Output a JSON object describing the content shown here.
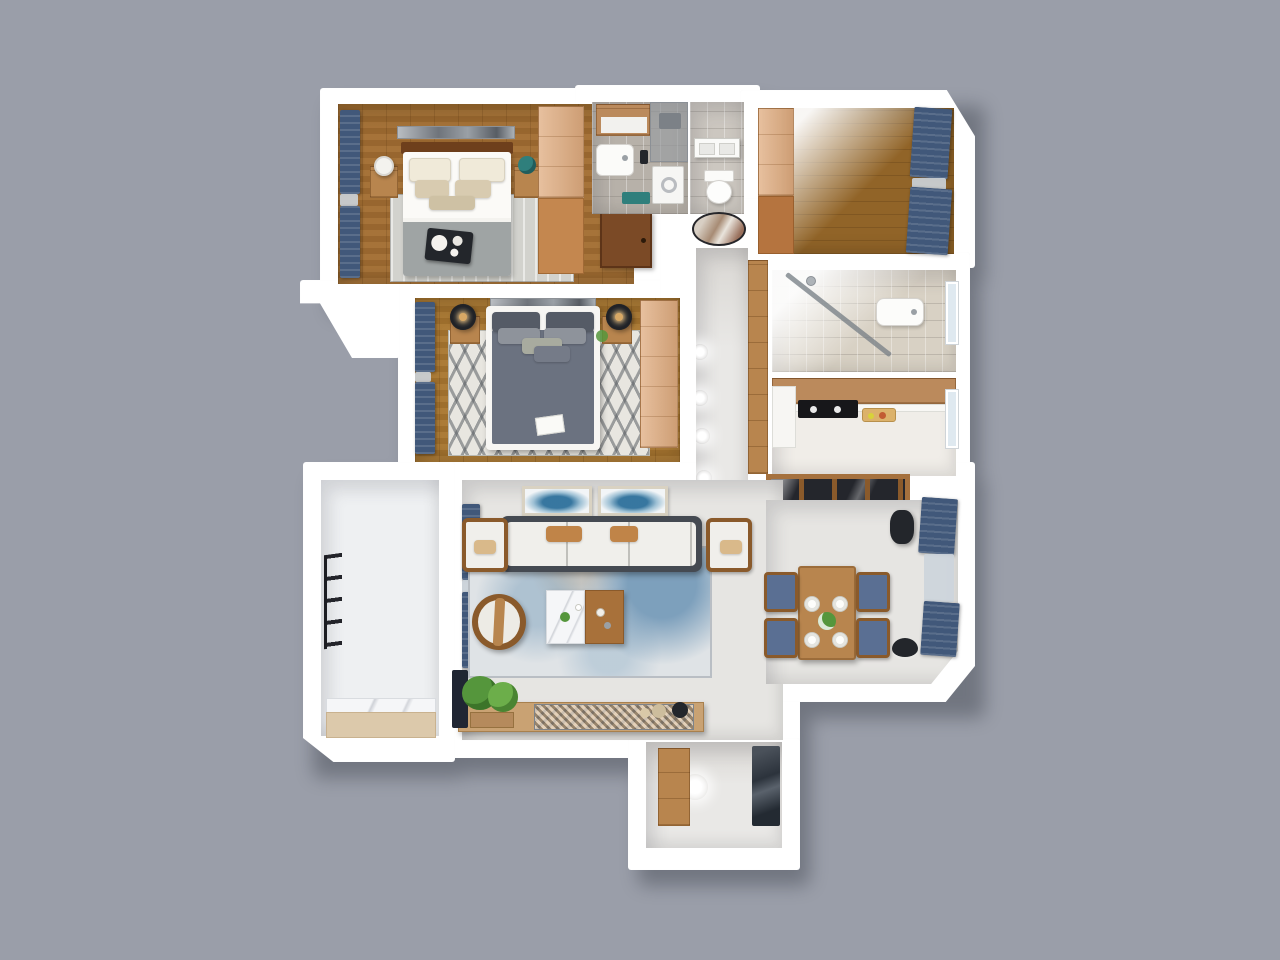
{
  "scene": {
    "title": "3D rendered top-down floor plan of a three-bedroom apartment",
    "view": "axonometric dollhouse render on plain gray backdrop",
    "background": "#9a9ea9"
  },
  "palette": {
    "background": "#9a9ea9",
    "wall": "#ffffff",
    "shadow": "#3f444e",
    "wood_floor_a": "#a06c31",
    "wood_floor_b": "#a7752f",
    "wood_floor_c": "#916428",
    "wood_light": "#dfab7e",
    "wood_mid": "#b8854e",
    "wood_cab": "#bb8a5c",
    "wood_dark": "#7b4a26",
    "headboard": "#6e3f1c",
    "navy": "#41587a",
    "sheer": "#ccd4dc",
    "tile_gray": "#b7b1a9",
    "tile_gray_light": "#ccc7c0",
    "tile_beige": "#d8d1c4",
    "kitchen_floor": "#f0ede8",
    "living_floor": "#e6e5e2",
    "hall_floor": "#e9e8e6",
    "balcony_floor": "#eef0f2",
    "rug_gray": "#d2d2cd",
    "rug_chevron": "#e8e6e0",
    "rug_living": "#dfe3e6",
    "duvet_gray": "#6b7280",
    "blanket_gray": "#9fa4a4",
    "sofa_frame": "#454a52",
    "cushion_white": "#f0efeb",
    "pillow_tan": "#c08448",
    "chair_blue": "#5a6f93",
    "teal": "#2f7f7c",
    "plant_green": "#55963c",
    "dark_object": "#23262b",
    "glow_white": "#ffffff",
    "partition_glass": "#24262c",
    "console_wood": "#c9a273",
    "bench_wood": "#dcc9ab",
    "marble": "#f5f6f8",
    "cooktop_black": "#17171a",
    "window_glass": "#dfe9f0",
    "art_blue": "#3a7fa8"
  },
  "rooms": [
    {
      "id": "bedroom-1",
      "label": "Bedroom 1 (top left)",
      "floor": "wood",
      "furniture": [
        "double-bed",
        "dark-headboard",
        "gray-wall-art",
        "nightstand-left",
        "white-table-lamp",
        "nightstand-right",
        "teal-plant",
        "gray-area-rug",
        "light-wood-wardrobe",
        "black-breakfast-tray",
        "navy-window-curtains",
        "entry-door"
      ]
    },
    {
      "id": "bathroom-1",
      "label": "Bathroom (top middle)",
      "floor": "gray-tile",
      "furniture": [
        "shower-glass",
        "mirror-cabinet",
        "vanity-sink",
        "washing-machine",
        "teal-bath-mat"
      ]
    },
    {
      "id": "wc",
      "label": "Toilet room",
      "floor": "gray-tile",
      "furniture": [
        "toilet",
        "towel-shelf"
      ]
    },
    {
      "id": "bedroom-3",
      "label": "Bedroom 3 (top right, unfurnished)",
      "floor": "wood",
      "furniture": [
        "light-wood-wardrobe",
        "navy-window-curtains"
      ]
    },
    {
      "id": "bathroom-2",
      "label": "Bathroom 2 (right)",
      "floor": "beige-tile",
      "furniture": [
        "glass-shower-screen",
        "sink",
        "window",
        "shower-head"
      ]
    },
    {
      "id": "kitchen",
      "label": "Kitchen",
      "floor": "white",
      "furniture": [
        "upper-cabinet-run",
        "white-counter",
        "black-cooktop",
        "cutting-board-with-food",
        "window",
        "glass-sliding-partition"
      ]
    },
    {
      "id": "bedroom-2",
      "label": "Master bedroom (middle)",
      "floor": "wood",
      "furniture": [
        "white-frame-bed",
        "gray-duvet",
        "chevron-rug",
        "nightstand-left",
        "nightstand-right",
        "dark-drum-lamps",
        "wardrobe",
        "navy-window-curtains",
        "wall-art",
        "white-book"
      ]
    },
    {
      "id": "hallway",
      "label": "Hallway",
      "floor": "light-gray",
      "furniture": [
        "oval-artwork",
        "wood-storage-cabinets",
        "recessed-spotlights"
      ]
    },
    {
      "id": "living-room",
      "label": "Living room",
      "floor": "light-gray",
      "furniture": [
        "gray-frame-sofa",
        "tan-accent-pillows",
        "armchair-left",
        "armchair-right",
        "round-barrel-chair",
        "two-tone-coffee-table",
        "blue-speckled-rug",
        "pair-of-blue-artworks",
        "tv-console",
        "mosaic-tv-panel",
        "green-plant",
        "navy-window-curtains",
        "decor-spheres",
        "dark-leaning-panel"
      ]
    },
    {
      "id": "balcony",
      "label": "Balcony / laundry (left)",
      "floor": "white",
      "furniture": [
        "drying-rack",
        "wood-bench",
        "marble-threshold"
      ]
    },
    {
      "id": "dining-room",
      "label": "Dining room",
      "floor": "light-gray",
      "furniture": [
        "wood-dining-table",
        "four-blue-chairs",
        "four-place-settings",
        "flower-centerpiece",
        "navy-window-curtains",
        "dark-floor-lamp",
        "dark-round-fan"
      ]
    },
    {
      "id": "entry",
      "label": "Entry hall (bottom)",
      "floor": "light-gray",
      "furniture": [
        "shoe-cabinet",
        "dark-wall-panel",
        "ceiling-light"
      ]
    }
  ],
  "lighting": {
    "hallway_spotlights": 5,
    "entry_lights": 1
  }
}
